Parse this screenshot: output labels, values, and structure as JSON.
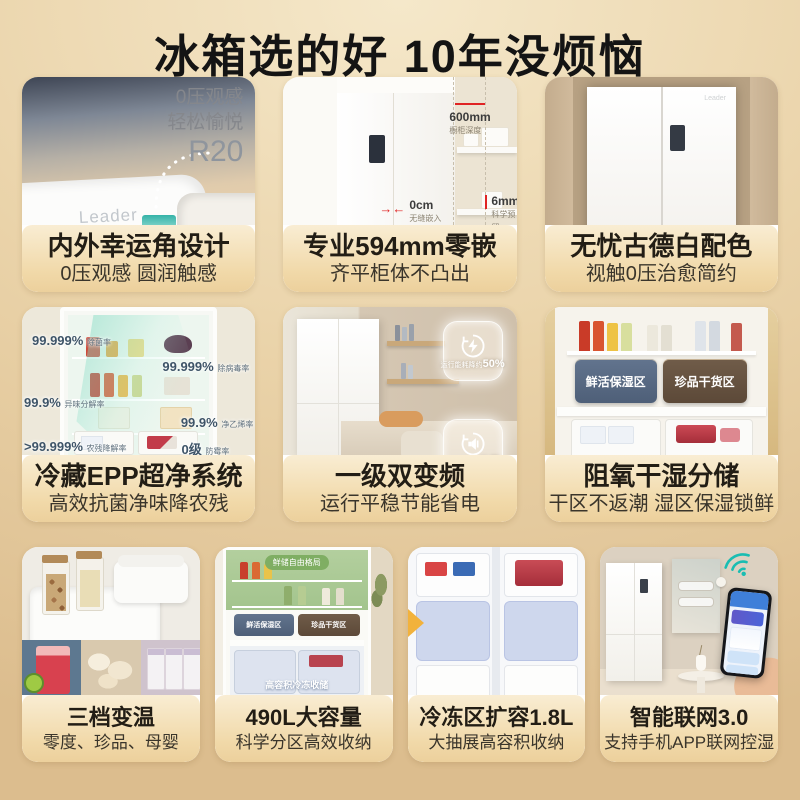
{
  "page": {
    "title": "冰箱选的好 10年没烦恼"
  },
  "colors": {
    "background_top": "#f5e8ca",
    "background_edge": "#dcbd8e",
    "caption_band": "#f1d9a9",
    "marker_red": "#e02424",
    "wifi_teal": "#1abdb2",
    "zone_wet_blue": "#5a6c85",
    "zone_dry_brown": "#6a5745"
  },
  "icons": {
    "badge_energy": "lightning-bolt-icon",
    "badge_noise": "low-noise-icon",
    "wifi": "wifi-icon"
  },
  "cards": [
    {
      "logo": "Leader",
      "overlay_line1": "0压观感",
      "overlay_line2": "轻松愉悦",
      "overlay_line3": "R20",
      "title": "内外幸运角设计",
      "subtitle": "0压观感 圆润触感"
    },
    {
      "markers": [
        {
          "value": "600mm",
          "label": "橱柜深度"
        },
        {
          "value": "6mm",
          "label": "科学预留"
        },
        {
          "value": "0cm",
          "label": "无缝嵌入"
        }
      ],
      "title": "专业594mm零嵌",
      "subtitle": "齐平柜体不凸出"
    },
    {
      "title": "无忧古德白配色",
      "subtitle": "视触0压治愈简约"
    },
    {
      "stats": [
        {
          "value": "99.999%",
          "label": "除菌率"
        },
        {
          "value": "99.999%",
          "label": "除病毒率"
        },
        {
          "value": "99.9%",
          "label": "异味分解率"
        },
        {
          "value": "99.9%",
          "label": "净乙烯率"
        },
        {
          "value": ">99.999%",
          "label": "农残降解率"
        },
        {
          "value": "0级",
          "label": "防霉率"
        }
      ],
      "title": "冷藏EPP超净系统",
      "subtitle": "高效抗菌净味降农残"
    },
    {
      "badges": [
        {
          "prefix": "运行能耗降约",
          "strong": "50%"
        },
        {
          "prefix": "运行约",
          "strong": "36分贝"
        }
      ],
      "title": "一级双变频",
      "subtitle": "运行平稳节能省电"
    },
    {
      "zones": [
        {
          "label": "鲜活保湿区"
        },
        {
          "label": "珍品干货区"
        }
      ],
      "title": "阻氧干湿分储",
      "subtitle": "干区不返潮 湿区保湿锁鲜"
    },
    {
      "title": "三档变温",
      "subtitle": "零度、珍品、母婴"
    },
    {
      "top_label": "鲜储自由格局",
      "zone1": "鲜活保湿区",
      "zone2": "珍品干货区",
      "freezer_label": "高容积冷冻收储",
      "title": "490L大容量",
      "subtitle": "科学分区高效收纳"
    },
    {
      "title": "冷冻区扩容1.8L",
      "subtitle": "大抽展高容积收纳"
    },
    {
      "title": "智能联网3.0",
      "subtitle": "支持手机APP联网控湿"
    }
  ]
}
